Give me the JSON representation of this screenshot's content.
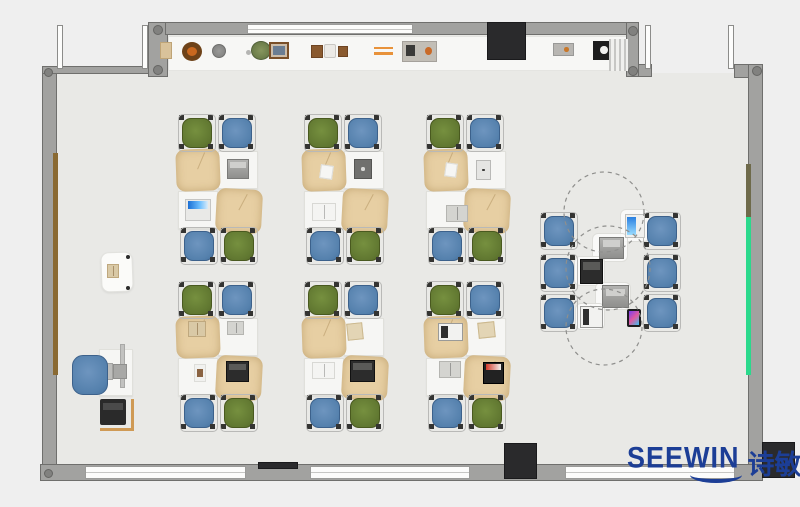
{
  "brand": {
    "wordmark": "SEEWIN",
    "cjk": "诗敏",
    "color": "#1c3e96"
  },
  "palette": {
    "background": "#efefef",
    "floor": "#e9e9e6",
    "wall": "#a2a2a0",
    "chair_green": "#617831",
    "chair_blue": "#5581ad",
    "desk_cover_tan": "#e7cfa3",
    "desk_white": "#f6f6f4",
    "green_board": "#2bd98c",
    "brown_rail": "#8a6a33",
    "dark_fixture": "#2a2a2c"
  },
  "floorplan": {
    "structure": [
      {
        "kind": "floor",
        "name": "room-floor",
        "x": 57,
        "y": 73,
        "w": 691,
        "h": 392
      },
      {
        "kind": "floor",
        "name": "room-floor-upper",
        "x": 166,
        "y": 35,
        "w": 460,
        "h": 38
      },
      {
        "kind": "shelfstrip",
        "name": "wall-shelf",
        "x": 168,
        "y": 36,
        "w": 470,
        "h": 35
      },
      {
        "kind": "wall",
        "name": "left-wall",
        "x": 42,
        "y": 66,
        "w": 15,
        "h": 414
      },
      {
        "kind": "wall",
        "name": "top-left-wall",
        "x": 42,
        "y": 66,
        "w": 108,
        "h": 8
      },
      {
        "kind": "wall",
        "name": "top-left-corner-column",
        "x": 148,
        "y": 22,
        "w": 20,
        "h": 55
      },
      {
        "kind": "wall",
        "name": "top-wall",
        "x": 165,
        "y": 22,
        "w": 473,
        "h": 13
      },
      {
        "kind": "wall",
        "name": "top-right-corner-column",
        "x": 626,
        "y": 22,
        "w": 13,
        "h": 55
      },
      {
        "kind": "wall",
        "name": "door-stub-wall",
        "x": 638,
        "y": 64,
        "w": 14,
        "h": 13
      },
      {
        "kind": "wall",
        "name": "top-right-wall",
        "x": 734,
        "y": 64,
        "w": 29,
        "h": 14
      },
      {
        "kind": "wall",
        "name": "right-wall",
        "x": 748,
        "y": 64,
        "w": 15,
        "h": 416
      },
      {
        "kind": "wall",
        "name": "bottom-wall",
        "x": 40,
        "y": 464,
        "w": 723,
        "h": 17
      },
      {
        "kind": "winband",
        "name": "top-window",
        "x": 247,
        "y": 24,
        "w": 166,
        "h": 10
      },
      {
        "kind": "post",
        "name": "bay-window-post",
        "x": 57,
        "y": 25,
        "w": 6,
        "h": 44
      },
      {
        "kind": "post",
        "name": "bay-window-post",
        "x": 142,
        "y": 25,
        "w": 6,
        "h": 44
      },
      {
        "kind": "post",
        "name": "door-post",
        "x": 645,
        "y": 25,
        "w": 6,
        "h": 44
      },
      {
        "kind": "post",
        "name": "door-post",
        "x": 728,
        "y": 25,
        "w": 6,
        "h": 44
      },
      {
        "kind": "winband",
        "name": "bottom-window-1",
        "x": 85,
        "y": 466,
        "w": 161,
        "h": 13
      },
      {
        "kind": "winband",
        "name": "bottom-window-2",
        "x": 310,
        "y": 466,
        "w": 160,
        "h": 13
      },
      {
        "kind": "winband",
        "name": "bottom-window-3",
        "x": 565,
        "y": 466,
        "w": 170,
        "h": 13
      },
      {
        "kind": "dot",
        "name": "wall-column-cap",
        "x": 44,
        "y": 68,
        "w": 9,
        "h": 9
      },
      {
        "kind": "dot",
        "name": "wall-column-cap",
        "x": 153,
        "y": 25,
        "w": 10,
        "h": 10
      },
      {
        "kind": "dot",
        "name": "wall-column-cap",
        "x": 153,
        "y": 65,
        "w": 10,
        "h": 10
      },
      {
        "kind": "dot",
        "name": "wall-column-cap",
        "x": 628,
        "y": 26,
        "w": 10,
        "h": 10
      },
      {
        "kind": "dot",
        "name": "wall-column-cap",
        "x": 628,
        "y": 66,
        "w": 10,
        "h": 10
      },
      {
        "kind": "dot",
        "name": "wall-column-cap",
        "x": 752,
        "y": 66,
        "w": 10,
        "h": 10
      },
      {
        "kind": "dot",
        "name": "wall-column-cap",
        "x": 44,
        "y": 469,
        "w": 9,
        "h": 9
      },
      {
        "kind": "board-brown",
        "name": "left-wall-rail",
        "x": 53,
        "y": 153,
        "w": 5,
        "h": 222
      },
      {
        "kind": "board-olive",
        "name": "right-wall-rail",
        "x": 746,
        "y": 164,
        "w": 5,
        "h": 53
      },
      {
        "kind": "board-green",
        "name": "green-board",
        "x": 746,
        "y": 217,
        "w": 5,
        "h": 158
      },
      {
        "kind": "fixture-dark",
        "name": "dark-cabinet",
        "x": 487,
        "y": 22,
        "w": 39,
        "h": 38
      },
      {
        "kind": "fixture-dark",
        "name": "dark-sill",
        "x": 258,
        "y": 462,
        "w": 40,
        "h": 7
      },
      {
        "kind": "fixture-dark",
        "name": "dark-pillar",
        "x": 504,
        "y": 443,
        "w": 33,
        "h": 36
      },
      {
        "kind": "fixture-dark",
        "name": "dark-pillar",
        "x": 762,
        "y": 442,
        "w": 33,
        "h": 36
      }
    ],
    "shelf_items": [
      {
        "kind": "box-tan",
        "name": "storage-box",
        "x": 160,
        "y": 42,
        "w": 12,
        "h": 17
      },
      {
        "kind": "wreath",
        "name": "wreath-decor",
        "x": 182,
        "y": 42,
        "w": 20,
        "h": 19
      },
      {
        "kind": "pot-gray",
        "name": "plant-pot",
        "x": 212,
        "y": 44,
        "w": 14,
        "h": 14
      },
      {
        "kind": "plant-dot",
        "name": "small-pot",
        "x": 246,
        "y": 50,
        "w": 5,
        "h": 5
      },
      {
        "kind": "plant-green",
        "name": "potted-plant",
        "x": 251,
        "y": 41,
        "w": 20,
        "h": 19
      },
      {
        "kind": "frame-pic",
        "name": "picture-frame",
        "x": 269,
        "y": 42,
        "w": 20,
        "h": 17
      },
      {
        "kind": "wood-box",
        "name": "wood-box",
        "x": 311,
        "y": 45,
        "w": 12,
        "h": 13
      },
      {
        "kind": "vase",
        "name": "vase",
        "x": 324,
        "y": 44,
        "w": 12,
        "h": 14
      },
      {
        "kind": "wood-box",
        "name": "wood-box",
        "x": 338,
        "y": 46,
        "w": 10,
        "h": 11
      },
      {
        "kind": "pencils",
        "name": "pencil-pair",
        "x": 374,
        "y": 47,
        "w": 19,
        "h": 8
      },
      {
        "kind": "tray",
        "name": "gadget-tray",
        "x": 402,
        "y": 41,
        "w": 35,
        "h": 21
      },
      {
        "kind": "device-dot",
        "name": "desk-gadget",
        "x": 553,
        "y": 43,
        "w": 21,
        "h": 13
      },
      {
        "kind": "device-black",
        "name": "printer-small",
        "x": 593,
        "y": 41,
        "w": 21,
        "h": 19
      },
      {
        "kind": "vent",
        "name": "radiator-vent",
        "x": 609,
        "y": 39,
        "w": 19,
        "h": 32
      }
    ],
    "clusters": {
      "origins": [
        {
          "x": 178,
          "y": 115
        },
        {
          "x": 304,
          "y": 115
        },
        {
          "x": 426,
          "y": 115
        },
        {
          "x": 178,
          "y": 282
        },
        {
          "x": 304,
          "y": 282
        },
        {
          "x": 426,
          "y": 282
        }
      ],
      "parts": [
        {
          "kind": "wdesk",
          "name": "student-desk",
          "x": 40,
          "y": 36,
          "w": 40,
          "h": 38
        },
        {
          "kind": "wdesk",
          "name": "student-desk",
          "x": 0,
          "y": 76,
          "w": 40,
          "h": 38
        },
        {
          "kind": "mat",
          "name": "desk-with-cover",
          "x": -2,
          "y": 34,
          "w": 44,
          "h": 42,
          "r": -2
        },
        {
          "kind": "mat",
          "name": "desk-with-cover",
          "x": 38,
          "y": 74,
          "w": 46,
          "h": 44,
          "r": 3
        },
        {
          "kind": "chair chair-green",
          "name": "student-chair-green",
          "x": 4,
          "y": 3,
          "w": 30,
          "h": 30
        },
        {
          "kind": "chair chair-blue",
          "name": "student-chair-blue",
          "x": 44,
          "y": 3,
          "w": 30,
          "h": 30
        },
        {
          "kind": "chair chair-blue",
          "name": "student-chair-blue",
          "x": 6,
          "y": 116,
          "w": 30,
          "h": 30
        },
        {
          "kind": "chair chair-green",
          "name": "student-chair-green",
          "x": 46,
          "y": 116,
          "w": 30,
          "h": 30
        }
      ],
      "items": [
        [
          {
            "kind": "laptop-gray",
            "name": "laptop",
            "x": 49,
            "y": 44,
            "w": 22,
            "h": 20
          },
          {
            "kind": "laptop-blue",
            "name": "laptop",
            "x": 7,
            "y": 84,
            "w": 26,
            "h": 22
          }
        ],
        [
          {
            "kind": "paper-white",
            "name": "paper",
            "x": 16,
            "y": 50,
            "w": 13,
            "h": 14
          },
          {
            "kind": "tablet-dark",
            "name": "tablet",
            "x": 50,
            "y": 44,
            "w": 18,
            "h": 20
          },
          {
            "kind": "book-white",
            "name": "open-book",
            "x": 8,
            "y": 88,
            "w": 24,
            "h": 18
          }
        ],
        [
          {
            "kind": "paper-white",
            "name": "paper",
            "x": 19,
            "y": 48,
            "w": 12,
            "h": 14
          },
          {
            "kind": "tablet-light",
            "name": "tablet",
            "x": 50,
            "y": 45,
            "w": 15,
            "h": 20
          },
          {
            "kind": "book-gray",
            "name": "open-book",
            "x": 20,
            "y": 90,
            "w": 22,
            "h": 17
          }
        ],
        [
          {
            "kind": "book-tan",
            "name": "open-book",
            "x": 10,
            "y": 39,
            "w": 18,
            "h": 16
          },
          {
            "kind": "book-gray",
            "name": "open-book",
            "x": 49,
            "y": 39,
            "w": 17,
            "h": 14
          },
          {
            "kind": "photo",
            "name": "photo-card",
            "x": 16,
            "y": 82,
            "w": 12,
            "h": 18
          },
          {
            "kind": "laptop-dark",
            "name": "laptop",
            "x": 48,
            "y": 79,
            "w": 23,
            "h": 21
          }
        ],
        [
          {
            "kind": "paper-tan",
            "name": "paper",
            "x": 43,
            "y": 41,
            "w": 16,
            "h": 17
          },
          {
            "kind": "book-white",
            "name": "open-book",
            "x": 8,
            "y": 80,
            "w": 23,
            "h": 17
          },
          {
            "kind": "laptop-dark",
            "name": "laptop",
            "x": 46,
            "y": 78,
            "w": 25,
            "h": 22
          }
        ],
        [
          {
            "kind": "laptop-white",
            "name": "laptop",
            "x": 12,
            "y": 41,
            "w": 25,
            "h": 18
          },
          {
            "kind": "paper-tan",
            "name": "paper",
            "x": 52,
            "y": 40,
            "w": 17,
            "h": 16
          },
          {
            "kind": "book-gray",
            "name": "open-book",
            "x": 13,
            "y": 79,
            "w": 22,
            "h": 17
          },
          {
            "kind": "laptop-red",
            "name": "laptop",
            "x": 57,
            "y": 80,
            "w": 21,
            "h": 22
          }
        ]
      ]
    },
    "collab_zone": {
      "table_outlines_dashed": [
        {
          "cx": 604,
          "cy": 212,
          "r": 40
        },
        {
          "cx": 608,
          "cy": 268,
          "r": 42
        },
        {
          "cx": 604,
          "cy": 327,
          "r": 38
        }
      ],
      "chairs": [
        {
          "x": 544,
          "y": 216
        },
        {
          "x": 544,
          "y": 258
        },
        {
          "x": 544,
          "y": 298
        },
        {
          "x": 647,
          "y": 216
        },
        {
          "x": 647,
          "y": 258
        },
        {
          "x": 647,
          "y": 298
        }
      ],
      "side_tables": [
        {
          "x": 620,
          "y": 209,
          "w": 30,
          "h": 33
        },
        {
          "x": 592,
          "y": 233,
          "w": 36,
          "h": 29
        },
        {
          "x": 574,
          "y": 256,
          "w": 31,
          "h": 30
        },
        {
          "x": 595,
          "y": 282,
          "w": 36,
          "h": 28
        },
        {
          "x": 575,
          "y": 303,
          "w": 30,
          "h": 27
        }
      ],
      "devices": [
        {
          "kind": "tablet-blue",
          "name": "tablet",
          "x": 625,
          "y": 214,
          "w": 20,
          "h": 24
        },
        {
          "kind": "laptop-gray",
          "name": "laptop",
          "x": 599,
          "y": 237,
          "w": 25,
          "h": 22
        },
        {
          "kind": "laptop-dark",
          "name": "laptop",
          "x": 580,
          "y": 259,
          "w": 23,
          "h": 25
        },
        {
          "kind": "laptop-gray",
          "name": "laptop",
          "x": 602,
          "y": 285,
          "w": 27,
          "h": 23
        },
        {
          "kind": "laptop-white",
          "name": "laptop",
          "x": 580,
          "y": 306,
          "w": 23,
          "h": 22
        },
        {
          "kind": "phone",
          "name": "smartphone",
          "x": 627,
          "y": 309,
          "w": 14,
          "h": 18
        }
      ]
    },
    "teacher_zone": [
      {
        "kind": "podium",
        "name": "lectern",
        "x": 101,
        "y": 252,
        "w": 32,
        "h": 40,
        "r": -2
      },
      {
        "kind": "book-tan",
        "name": "open-book",
        "x": 107,
        "y": 264,
        "w": 12,
        "h": 14
      },
      {
        "kind": "dot-sm",
        "name": "lectern-knob",
        "x": 126,
        "y": 255,
        "w": 4,
        "h": 4
      },
      {
        "kind": "dot-sm",
        "name": "lectern-knob",
        "x": 126,
        "y": 286,
        "w": 4,
        "h": 4
      },
      {
        "kind": "wdesk",
        "name": "teacher-desk",
        "x": 99,
        "y": 349,
        "w": 34,
        "h": 47
      },
      {
        "kind": "monitor-line",
        "name": "monitor",
        "x": 120,
        "y": 344,
        "w": 5,
        "h": 44
      },
      {
        "kind": "monitor-box",
        "name": "monitor-base",
        "x": 113,
        "y": 364,
        "w": 14,
        "h": 15
      },
      {
        "kind": "keyboard",
        "name": "keyboard",
        "x": 104,
        "y": 363,
        "w": 9,
        "h": 17
      },
      {
        "kind": "tchair",
        "name": "teacher-chair",
        "x": 72,
        "y": 355,
        "w": 36,
        "h": 40
      },
      {
        "kind": "lline-v",
        "name": "return-desk-edge",
        "x": 131,
        "y": 399,
        "w": 3,
        "h": 32
      },
      {
        "kind": "lline-h",
        "name": "return-desk-edge",
        "x": 100,
        "y": 428,
        "w": 34,
        "h": 3
      },
      {
        "kind": "printer",
        "name": "printer",
        "x": 100,
        "y": 399,
        "w": 26,
        "h": 26
      }
    ]
  }
}
